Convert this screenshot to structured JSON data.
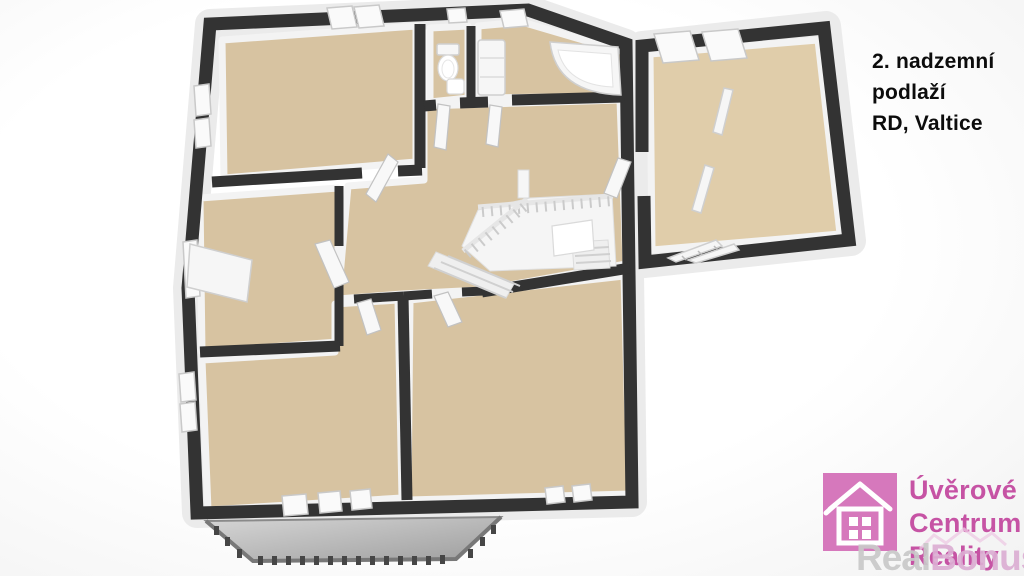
{
  "title": {
    "line1": "2. nadzemní",
    "line2": "podlaží",
    "line3": "RD, Valtice"
  },
  "brand": {
    "line1": "Úvěrové",
    "line2": "Centrum",
    "line3": "Reality"
  },
  "watermark": {
    "part1": "Real",
    "part2": "Bonus",
    "part3": ".cz"
  },
  "colors": {
    "wall": "#333333",
    "floor": "#d7c3a1",
    "floor_light": "#e0cdaa",
    "balcony_light": "#d4d4d4",
    "balcony_dark": "#9e9e9e",
    "brand_pink": "#d678bc",
    "brand_text": "#c653a4",
    "watermark_gray": "#c9c9c9",
    "watermark_pink": "#dcaed3",
    "title_text": "#0c0c0c"
  }
}
